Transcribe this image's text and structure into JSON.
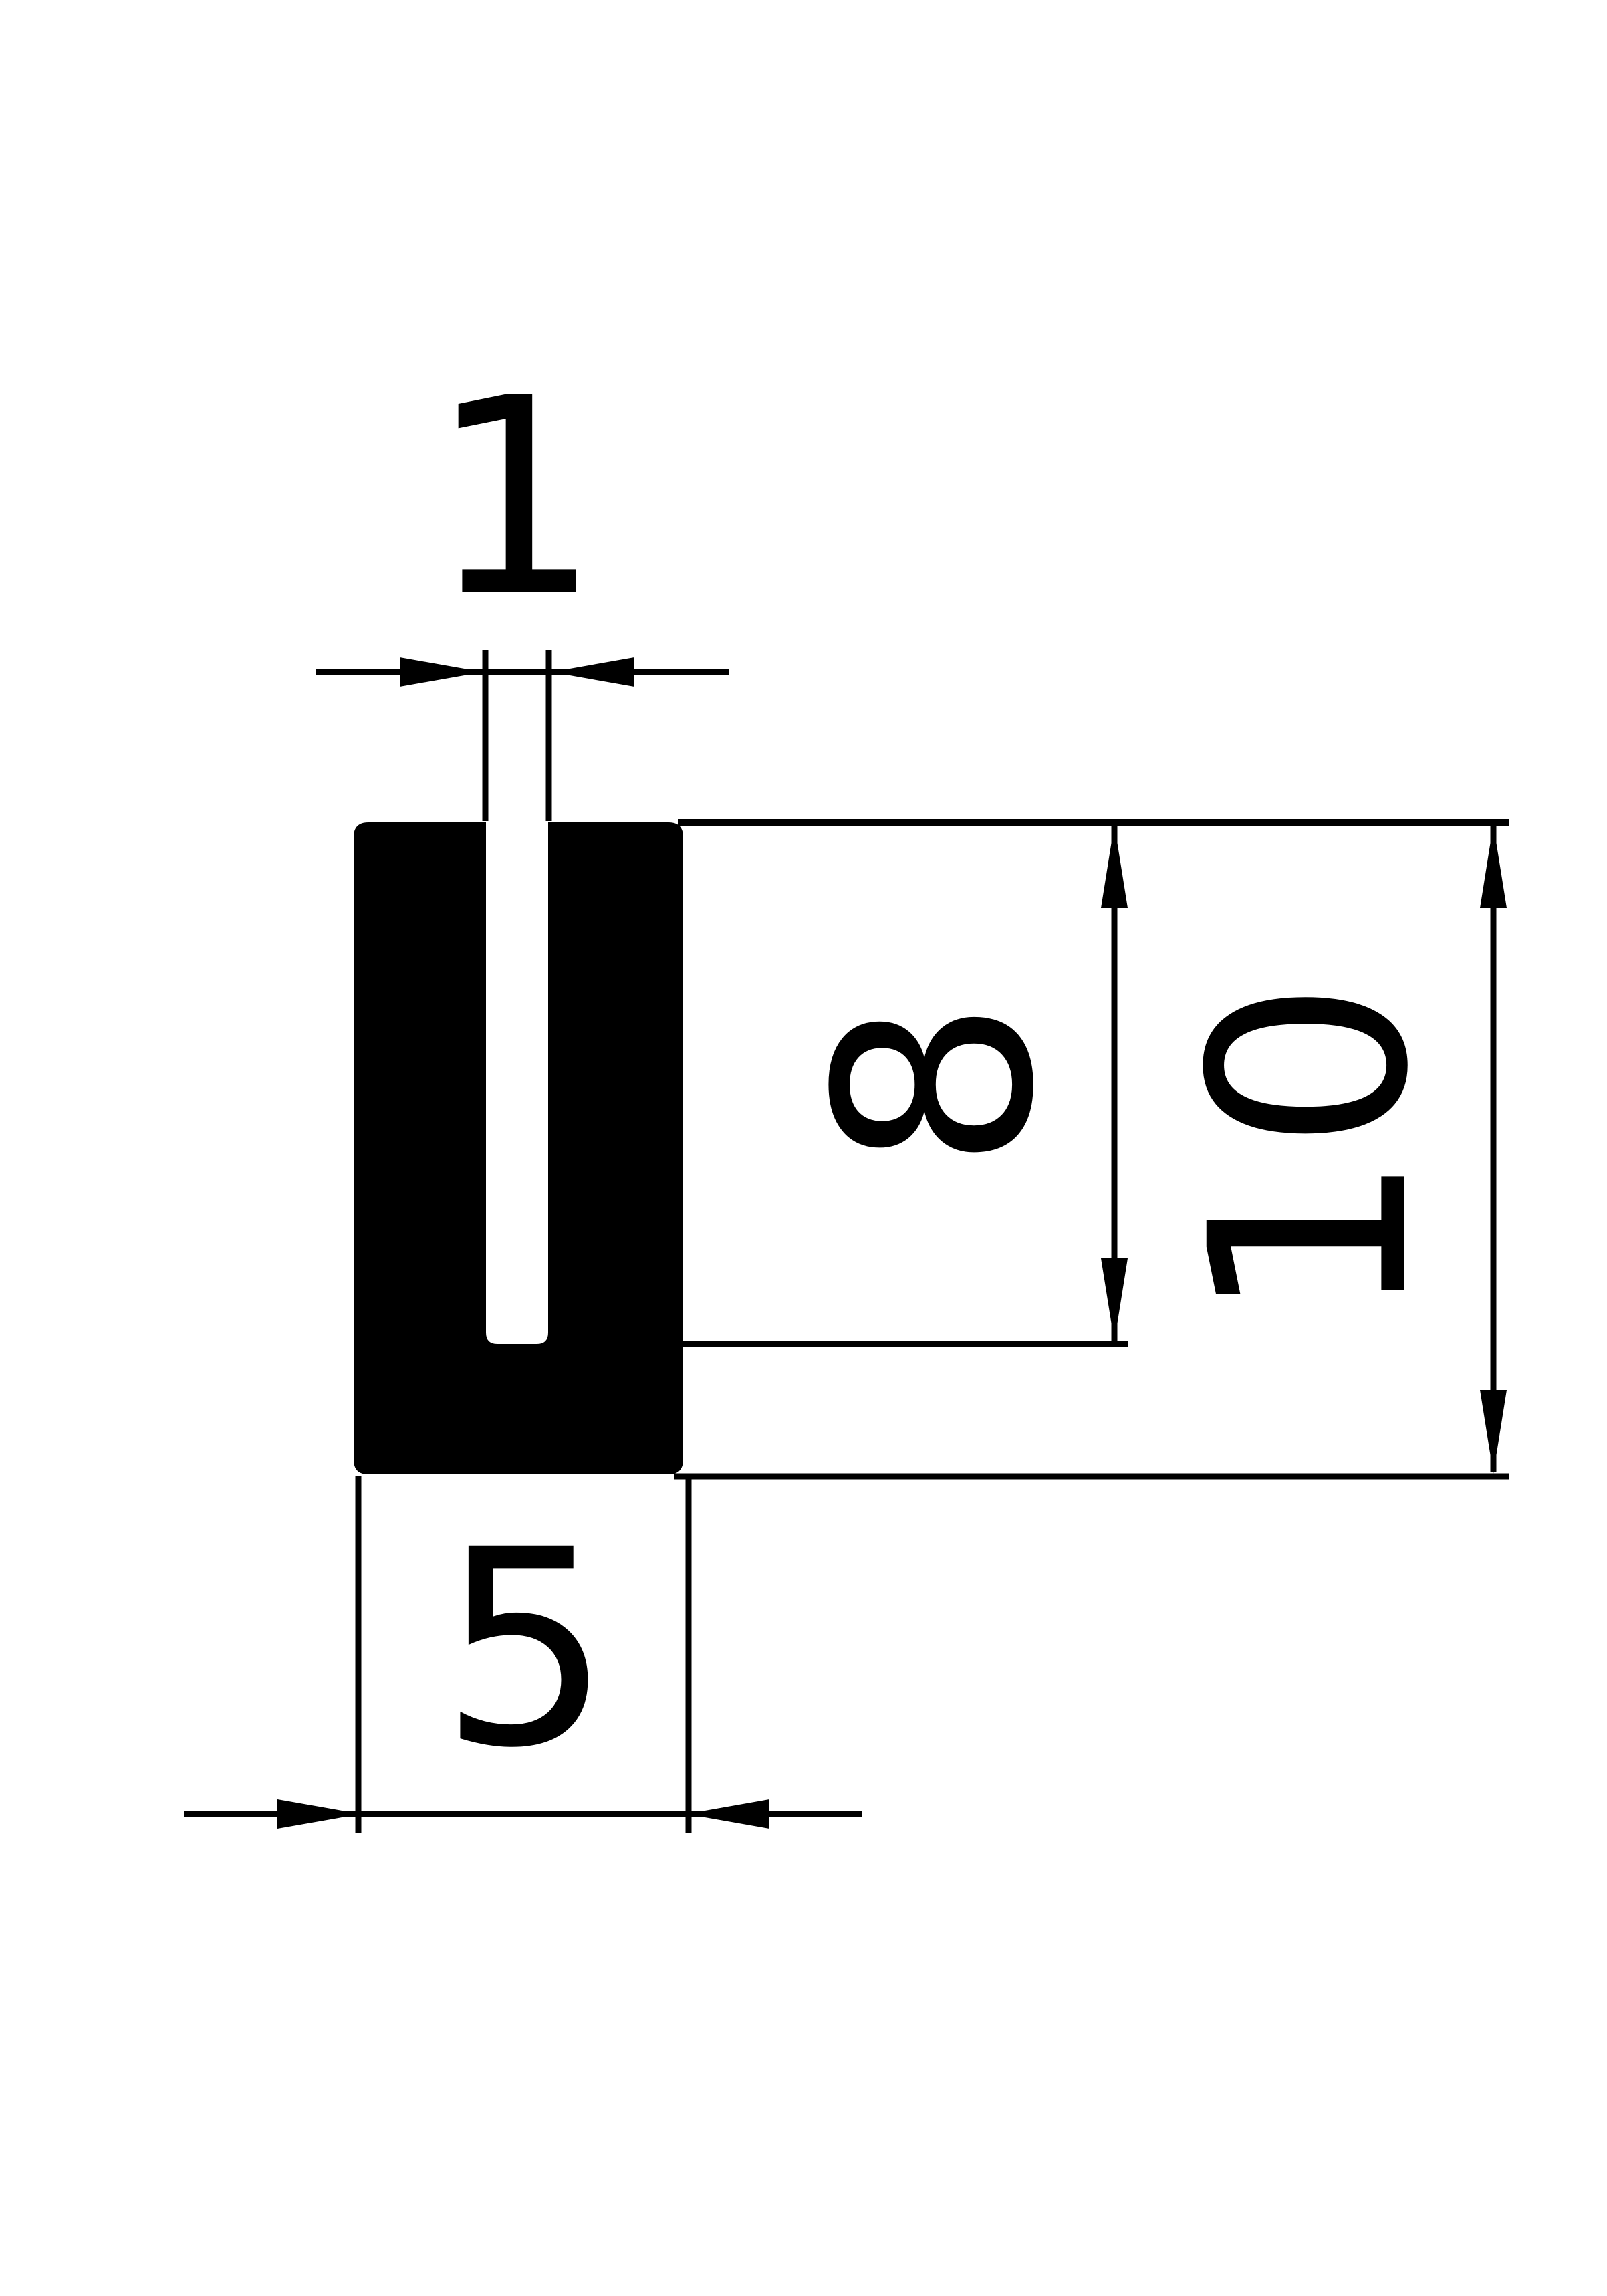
{
  "drawing": {
    "background_color": "#ffffff",
    "line_color": "#000000",
    "profile": {
      "fill_color": "#000000",
      "kind": "u-channel-cross-section"
    },
    "dimensions": {
      "slot_width": {
        "label": "1"
      },
      "groove_depth": {
        "label": "8"
      },
      "total_height": {
        "label": "10"
      },
      "base_width": {
        "label": "5"
      }
    }
  }
}
